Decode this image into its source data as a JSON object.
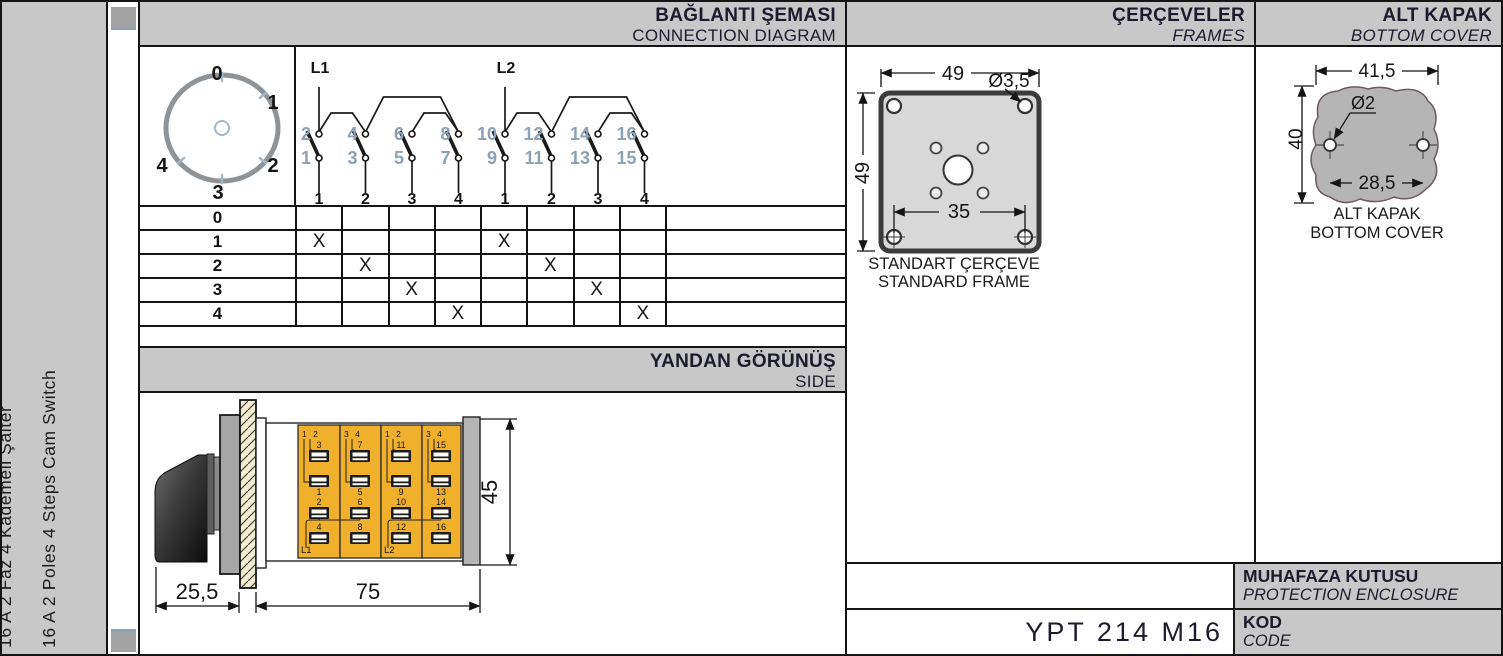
{
  "sidebar": {
    "title_tr": "16 A 2 Faz 4 Kademeli Şalter",
    "title_en": "16 A 2 Poles 4 Steps Cam Switch"
  },
  "connection": {
    "title_tr": "BAĞLANTI ŞEMASI",
    "title_en": "CONNECTION DIAGRAM",
    "dial_positions": [
      "0",
      "1",
      "2",
      "3",
      "4"
    ],
    "poles": [
      {
        "label": "L1",
        "contacts": [
          {
            "top": "2",
            "bottom": "1",
            "step": "1"
          },
          {
            "top": "4",
            "bottom": "3",
            "step": "2"
          },
          {
            "top": "6",
            "bottom": "5",
            "step": "3"
          },
          {
            "top": "8",
            "bottom": "7",
            "step": "4"
          }
        ]
      },
      {
        "label": "L2",
        "contacts": [
          {
            "top": "10",
            "bottom": "9",
            "step": "1"
          },
          {
            "top": "12",
            "bottom": "11",
            "step": "2"
          },
          {
            "top": "14",
            "bottom": "13",
            "step": "3"
          },
          {
            "top": "16",
            "bottom": "15",
            "step": "4"
          }
        ]
      }
    ],
    "table": {
      "mark_symbol": "X",
      "rows": [
        {
          "label": "0",
          "marks": [
            0,
            0,
            0,
            0,
            0,
            0,
            0,
            0
          ]
        },
        {
          "label": "1",
          "marks": [
            1,
            0,
            0,
            0,
            1,
            0,
            0,
            0
          ]
        },
        {
          "label": "2",
          "marks": [
            0,
            1,
            0,
            0,
            0,
            1,
            0,
            0
          ]
        },
        {
          "label": "3",
          "marks": [
            0,
            0,
            1,
            0,
            0,
            0,
            1,
            0
          ]
        },
        {
          "label": "4",
          "marks": [
            0,
            0,
            0,
            1,
            0,
            0,
            0,
            1
          ]
        }
      ]
    }
  },
  "side_view": {
    "title_tr": "YANDAN GÖRÜNÜŞ",
    "title_en": "SIDE",
    "dim_depth": "25,5",
    "dim_length": "75",
    "dim_height": "45",
    "modules": [
      {
        "corner": "1 2",
        "t_top": "3",
        "t_bottom": "1",
        "b_top": "2",
        "b_bottom": "4",
        "feed": "L1"
      },
      {
        "corner": "3 4",
        "t_top": "7",
        "t_bottom": "5",
        "b_top": "6",
        "b_bottom": "8",
        "feed": ""
      },
      {
        "corner": "1 2",
        "t_top": "11",
        "t_bottom": "9",
        "b_top": "10",
        "b_bottom": "12",
        "feed": "L2"
      },
      {
        "corner": "3 4",
        "t_top": "15",
        "t_bottom": "13",
        "b_top": "14",
        "b_bottom": "16",
        "feed": ""
      }
    ]
  },
  "frames": {
    "title_tr": "ÇERÇEVELER",
    "title_en": "FRAMES",
    "dim_width": "49",
    "dim_height": "49",
    "dim_hole": "Ø3,5",
    "dim_hole_spacing": "35",
    "caption_tr": "STANDART ÇERÇEVE",
    "caption_en": "STANDARD FRAME"
  },
  "bottom_cover": {
    "title_tr": "ALT KAPAK",
    "title_en": "BOTTOM COVER",
    "dim_width": "41,5",
    "dim_height": "40",
    "dim_hole": "Ø2",
    "dim_hole_spacing": "28,5",
    "caption_tr": "ALT KAPAK",
    "caption_en": "BOTTOM COVER"
  },
  "footer": {
    "enclosure_tr": "MUHAFAZA KUTUSU",
    "enclosure_en": "PROTECTION ENCLOSURE",
    "code_label_tr": "KOD",
    "code_label_en": "CODE",
    "code_value": "YPT 214 M16"
  },
  "colors": {
    "header_bg": "#c8c8c8",
    "module_yellow": "#f0b02c",
    "terminal_number_gray": "#8ca1b6",
    "frame_fill": "#d8d8d8",
    "cover_fill": "#b5b5b5",
    "line": "#141414"
  }
}
